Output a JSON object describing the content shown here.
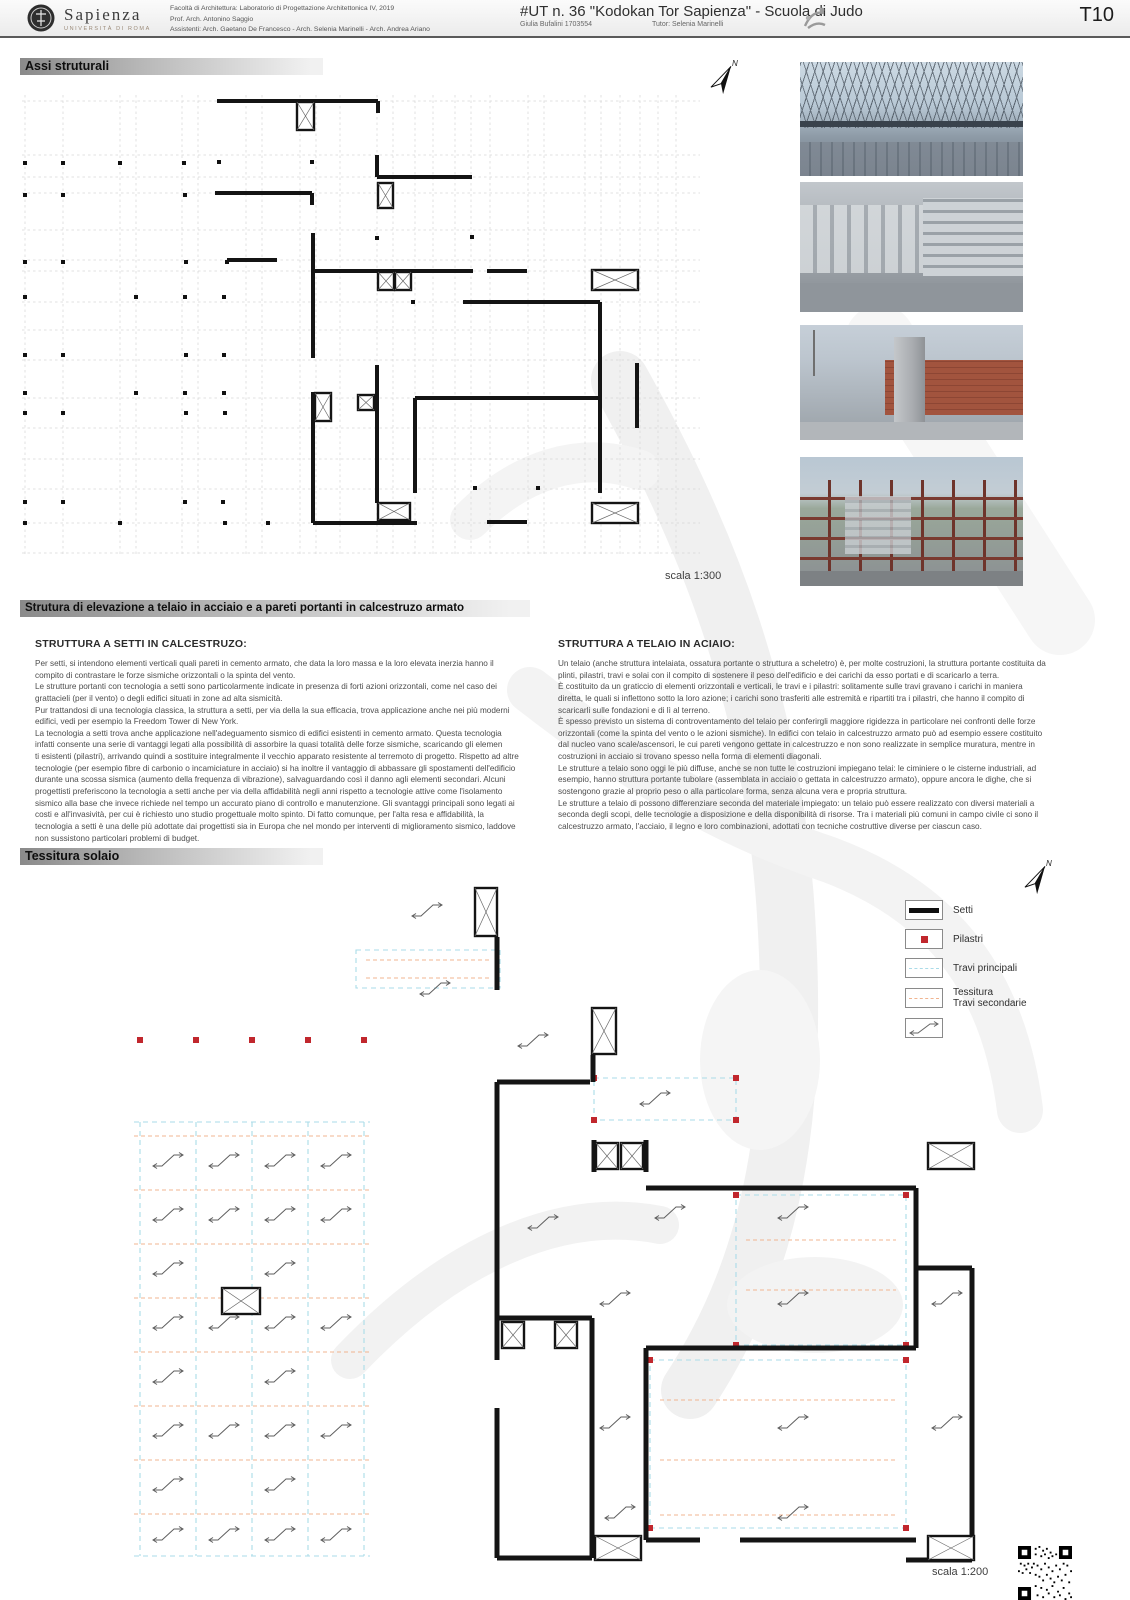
{
  "header": {
    "logo_name": "Sapienza",
    "logo_sub": "UNIVERSITÀ DI ROMA",
    "course_lines": [
      "Facoltà di Architettura: Laboratorio di Progettazione Architettonica IV, 2019",
      "Prof. Arch. Antonino Saggio",
      "Assistenti: Arch. Gaetano De Francesco - Arch. Selenia Marinelli - Arch. Andrea Ariano"
    ],
    "project_title": "#UT n. 36 \"Kodokan Tor Sapienza\" - Scuola di Judo",
    "student": "Giulia Bufalini 1703554",
    "tutor": "Tutor: Selenia Marinelli",
    "sheet_number": "T10"
  },
  "sections": {
    "assi": {
      "title": "Assi struturali",
      "scale": "scala 1:300"
    },
    "elevazione": {
      "title": "Strutura di elevazione a telaio in acciaio e a pareti portanti in calcestruzo armato",
      "left": {
        "heading": "STRUTTURA A SETTI IN CALCESTRUZO:",
        "body": "Per setti, si intendono elementi verticali quali pareti in cemento armato, che data la loro massa e la loro elevata inerzia hanno il compito di contrastare le forze sismiche orizzontali o la spinta del vento.\nLe strutture portanti con tecnologia a setti sono particolarmente indicate in presenza di forti azioni orizzontali, come nel caso dei grattacieli (per il vento) o degli edifici situati in zone ad alta sismicità.\nPur trattandosi di una tecnologia classica, la struttura a setti, per via della la sua efficacia, trova applicazione anche nei più moderni edifici, vedi per esempio la Freedom Tower di New York.\nLa tecnologia a setti trova anche applicazione nell'adeguamento sismico di edifici esistenti in cemento armato. Questa tecnologia infatti consente una serie di vantaggi legati alla possibilità di assorbire la quasi totalità delle forze sismiche, scaricando gli elemen\nti esistenti (pilastri), arrivando quindi a sostituire integralmente il vecchio apparato resistente al terremoto di progetto. Rispetto ad altre tecnologie (per esempio fibre di carbonio o incamiciature in acciaio) si ha inoltre il vantaggio di abbassare gli spostamenti dell'edificio durante una scossa sismica (aumento della frequenza di vibrazione), salvaguardando così il danno agli elementi secondari. Alcuni progettisti preferiscono la tecnologia a setti anche per via della affidabilità negli anni rispetto a tecnologie attive come l'isolamento sismico alla base che invece richiede nel tempo un accurato piano di controllo e manutenzione. Gli svantaggi principali sono legati ai costi e all'invasività, per cui è richiesto uno studio progettuale molto spinto. Di fatto comunque, per l'alta resa e affidabilità, la tecnologia a setti è una delle più adottate dai progettisti sia in Europa che nel mondo per interventi di miglioramento sismico, laddove non sussistono particolari problemi di budget."
      },
      "right": {
        "heading": "STRUTTURA A TELAIO IN ACIAIO:",
        "body": "Un telaio (anche struttura intelaiata, ossatura portante o struttura a scheletro) è, per molte costruzioni, la struttura portante costituita da plinti, pilastri, travi e solai con il compito di sostenere il peso dell'edificio e dei carichi da esso portati e di scaricarlo a terra.\nÈ costituito da un graticcio di elementi orizzontali e verticali, le travi e i pilastri: solitamente sulle travi gravano i carichi in maniera diretta, le quali si inflettono sotto la loro azione; i carichi sono trasferiti alle estremità e ripartiti tra i pilastri, che hanno il compito di scaricarli sulle fondazioni e di lì al terreno.\nÈ spesso previsto un sistema di controventamento del telaio per conferirgli maggiore rigidezza in particolare nei confronti delle forze orizzontali (come la spinta del vento o le azioni sismiche). In edifici con telaio in calcestruzzo armato può ad esempio essere costituito dal nucleo vano scale/ascensori, le cui pareti vengono gettate in calcestruzzo e non sono realizzate in semplice muratura, mentre in costruzioni in acciaio si trovano spesso nella forma di elementi diagonali.\nLe strutture a telaio sono oggi le più diffuse, anche se non tutte le costruzioni impiegano telai: le ciminiere o le cisterne industriali, ad esempio, hanno struttura portante tubolare (assemblata in acciaio o gettata in calcestruzzo armato), oppure ancora le dighe, che si sostengono grazie al proprio peso o alla particolare forma, senza alcuna vera e propria struttura.\nLe strutture a telaio di possono differenziare seconda del materiale impiegato: un telaio può essere realizzato con diversi materiali a seconda degli scopi, delle tecnologie a disposizione e della disponibilità di risorse. Tra i materiali più comuni in campo civile ci sono il calcestruzzo armato, l'acciaio, il legno e loro combinazioni, adottati con tecniche costruttive diverse per ciascun caso."
      }
    },
    "tessitura": {
      "title": "Tessitura solaio",
      "scale": "scala 1:200"
    }
  },
  "legend": {
    "setti": "Setti",
    "pilastri": "Pilastri",
    "travi_principali": "Travi principali",
    "tessitura_line1": "Tessitura",
    "tessitura_line2": "Travi secondarie"
  },
  "compass_label": "N",
  "colors": {
    "setti": "#0f0f0f",
    "pilastri": "#c1272d",
    "travi_principali": "#aadbe8",
    "travi_secondarie": "#f0b490"
  },
  "photos": {
    "descriptions": [
      "steel space-frame roof under construction",
      "concrete shear walls with formwork",
      "brick and concrete core with crane",
      "weathering-steel frame multi-storey structure"
    ]
  }
}
